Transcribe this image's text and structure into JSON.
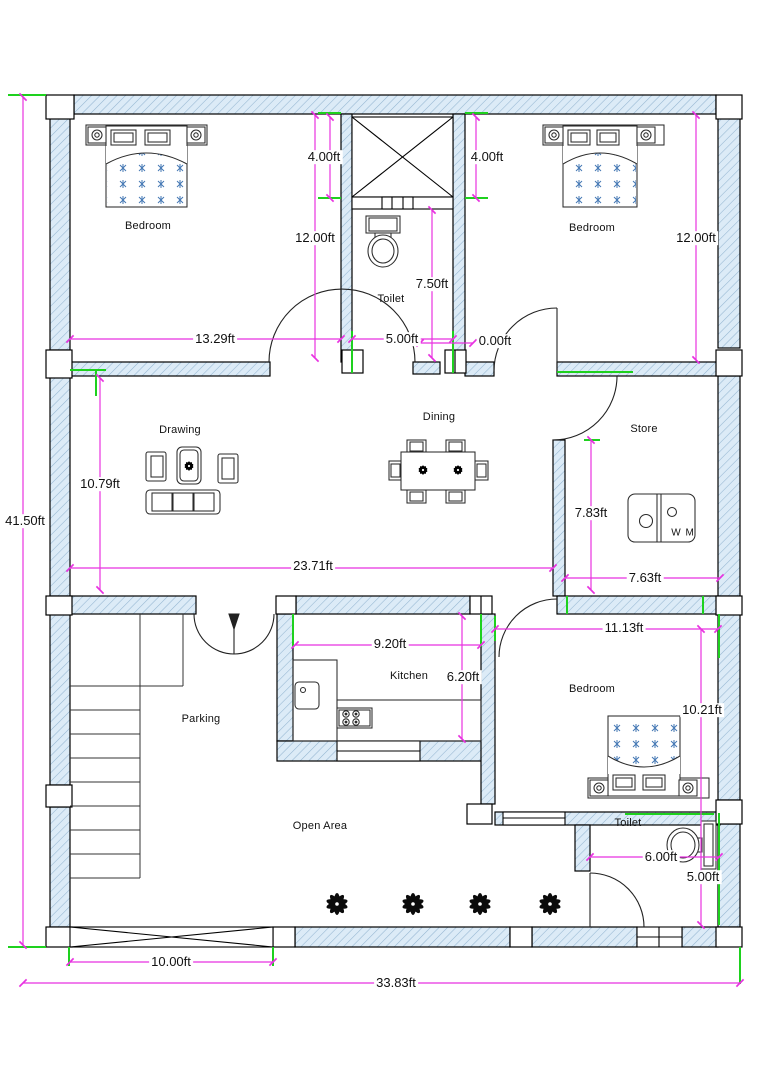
{
  "title": "House Floor Plan",
  "unit": "ft",
  "colors": {
    "wall_fill": "#dcebf7",
    "wall_hatch": "#94b6d1",
    "outline": "#000000",
    "dimension_line": "#e832e0",
    "witness_mark": "#1ed11e",
    "bed_pattern": "#4377b3"
  },
  "rooms": [
    {
      "id": "bedroom-1",
      "label": "Bedroom"
    },
    {
      "id": "toilet-1",
      "label": "Toilet"
    },
    {
      "id": "bedroom-2",
      "label": "Bedroom"
    },
    {
      "id": "drawing-room",
      "label": "Drawing"
    },
    {
      "id": "dining",
      "label": "Dining"
    },
    {
      "id": "store",
      "label": "Store"
    },
    {
      "id": "parking",
      "label": "Parking"
    },
    {
      "id": "kitchen",
      "label": "Kitchen"
    },
    {
      "id": "bedroom-3",
      "label": "Bedroom"
    },
    {
      "id": "open-area",
      "label": "Open Area"
    },
    {
      "id": "toilet-2",
      "label": "Toilet"
    }
  ],
  "appliances": {
    "washing_machine_label": "W M"
  },
  "dimensions": [
    {
      "id": "stair-shaft-left",
      "label": "4.00ft"
    },
    {
      "id": "stair-shaft-right",
      "label": "4.00ft"
    },
    {
      "id": "bedroom-1-depth",
      "label": "12.00ft"
    },
    {
      "id": "bedroom-2-depth",
      "label": "12.00ft"
    },
    {
      "id": "toilet-1-depth",
      "label": "7.50ft"
    },
    {
      "id": "bedroom-1-width",
      "label": "13.29ft"
    },
    {
      "id": "toilet-1-width",
      "label": "5.00ft"
    },
    {
      "id": "wall-offset",
      "label": "0.00ft"
    },
    {
      "id": "drawing-depth",
      "label": "10.79ft"
    },
    {
      "id": "hall-width",
      "label": "23.71ft"
    },
    {
      "id": "store-depth",
      "label": "7.83ft"
    },
    {
      "id": "store-width",
      "label": "7.63ft"
    },
    {
      "id": "kitchen-width",
      "label": "9.20ft"
    },
    {
      "id": "bedroom-3-width",
      "label": "11.13ft"
    },
    {
      "id": "kitchen-depth",
      "label": "6.20ft"
    },
    {
      "id": "bedroom-3-depth",
      "label": "10.21ft"
    },
    {
      "id": "toilet-2-width",
      "label": "6.00ft"
    },
    {
      "id": "toilet-2-depth",
      "label": "5.00ft"
    },
    {
      "id": "plot-depth",
      "label": "41.50ft"
    },
    {
      "id": "gate-width",
      "label": "10.00ft"
    },
    {
      "id": "plot-width",
      "label": "33.83ft"
    }
  ],
  "icons": {
    "bed-icon": "double bed plan symbol with pillows and patterned blanket",
    "sofa-icon": "three-seat sofa",
    "armchair-icon": "single armchair",
    "coffee-table-icon": "table with plant",
    "dining-table-icon": "six-seat dining table",
    "washing-machine-icon": "WM top view",
    "sink-icon": "kitchen sink",
    "stove-icon": "4-burner hob",
    "toilet-icon": "WC with cistern",
    "plant-icon": "black plant glyph",
    "staircase-icon": "stair treads",
    "gate-icon": "crossed opening",
    "stair-shaft-icon": "crossed duct box"
  }
}
